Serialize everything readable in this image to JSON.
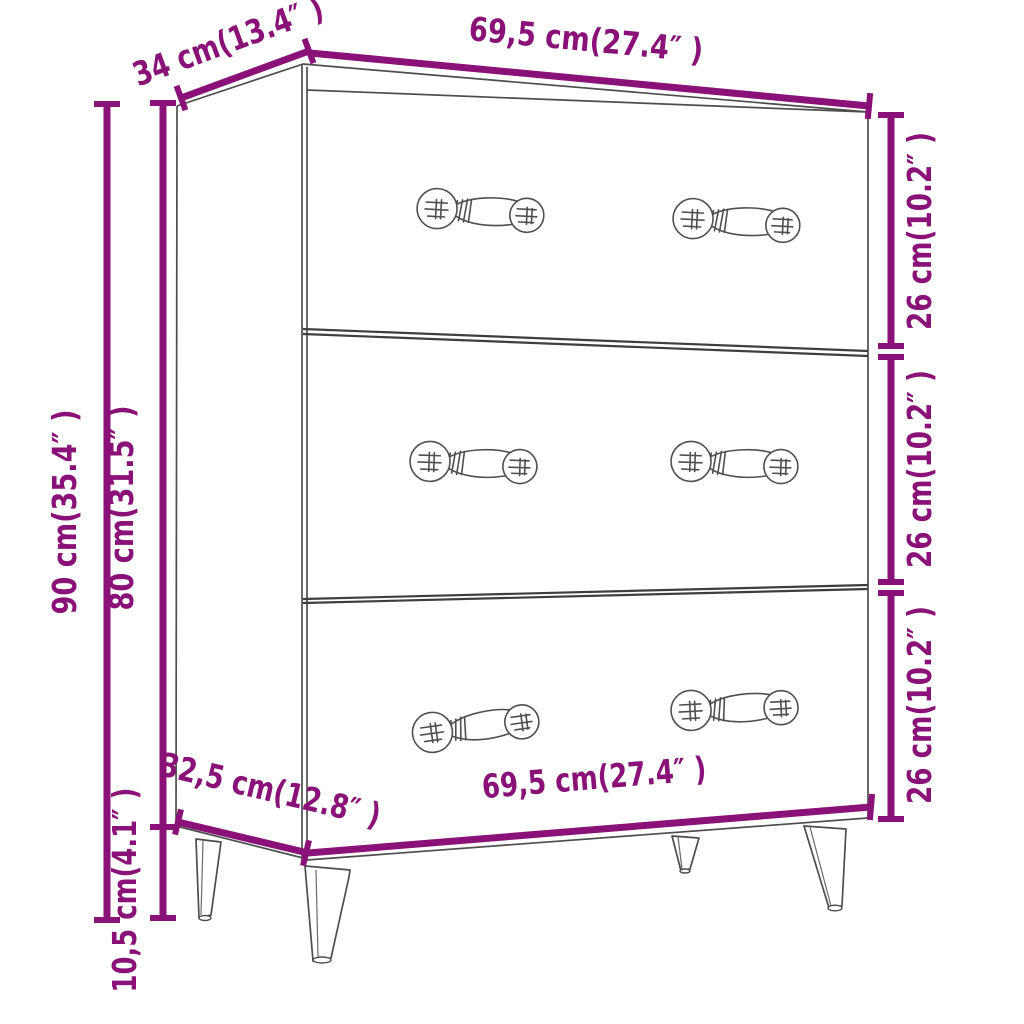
{
  "diagram": {
    "type": "furniture-dimension-diagram",
    "product": "3-drawer sideboard line drawing",
    "accent_color": "#8A1178",
    "line_color": "#4d4d4d",
    "labels": {
      "depth_top": "34 cm(13.4″ )",
      "width_top": "69,5 cm(27.4″ )",
      "drawer_top_height": "26 cm(10.2″ )",
      "drawer_middle_height": "26 cm(10.2″ )",
      "drawer_bottom_height": "26 cm(10.2″ )",
      "height_overall": "90 cm(35.4″ )",
      "height_body": "80 cm(31.5″ )",
      "depth_bottom": "32,5 cm(12.8″ )",
      "width_bottom": "69,5 cm(27.4″ )",
      "leg_height": "10,5 cm(4.1″ )"
    }
  }
}
